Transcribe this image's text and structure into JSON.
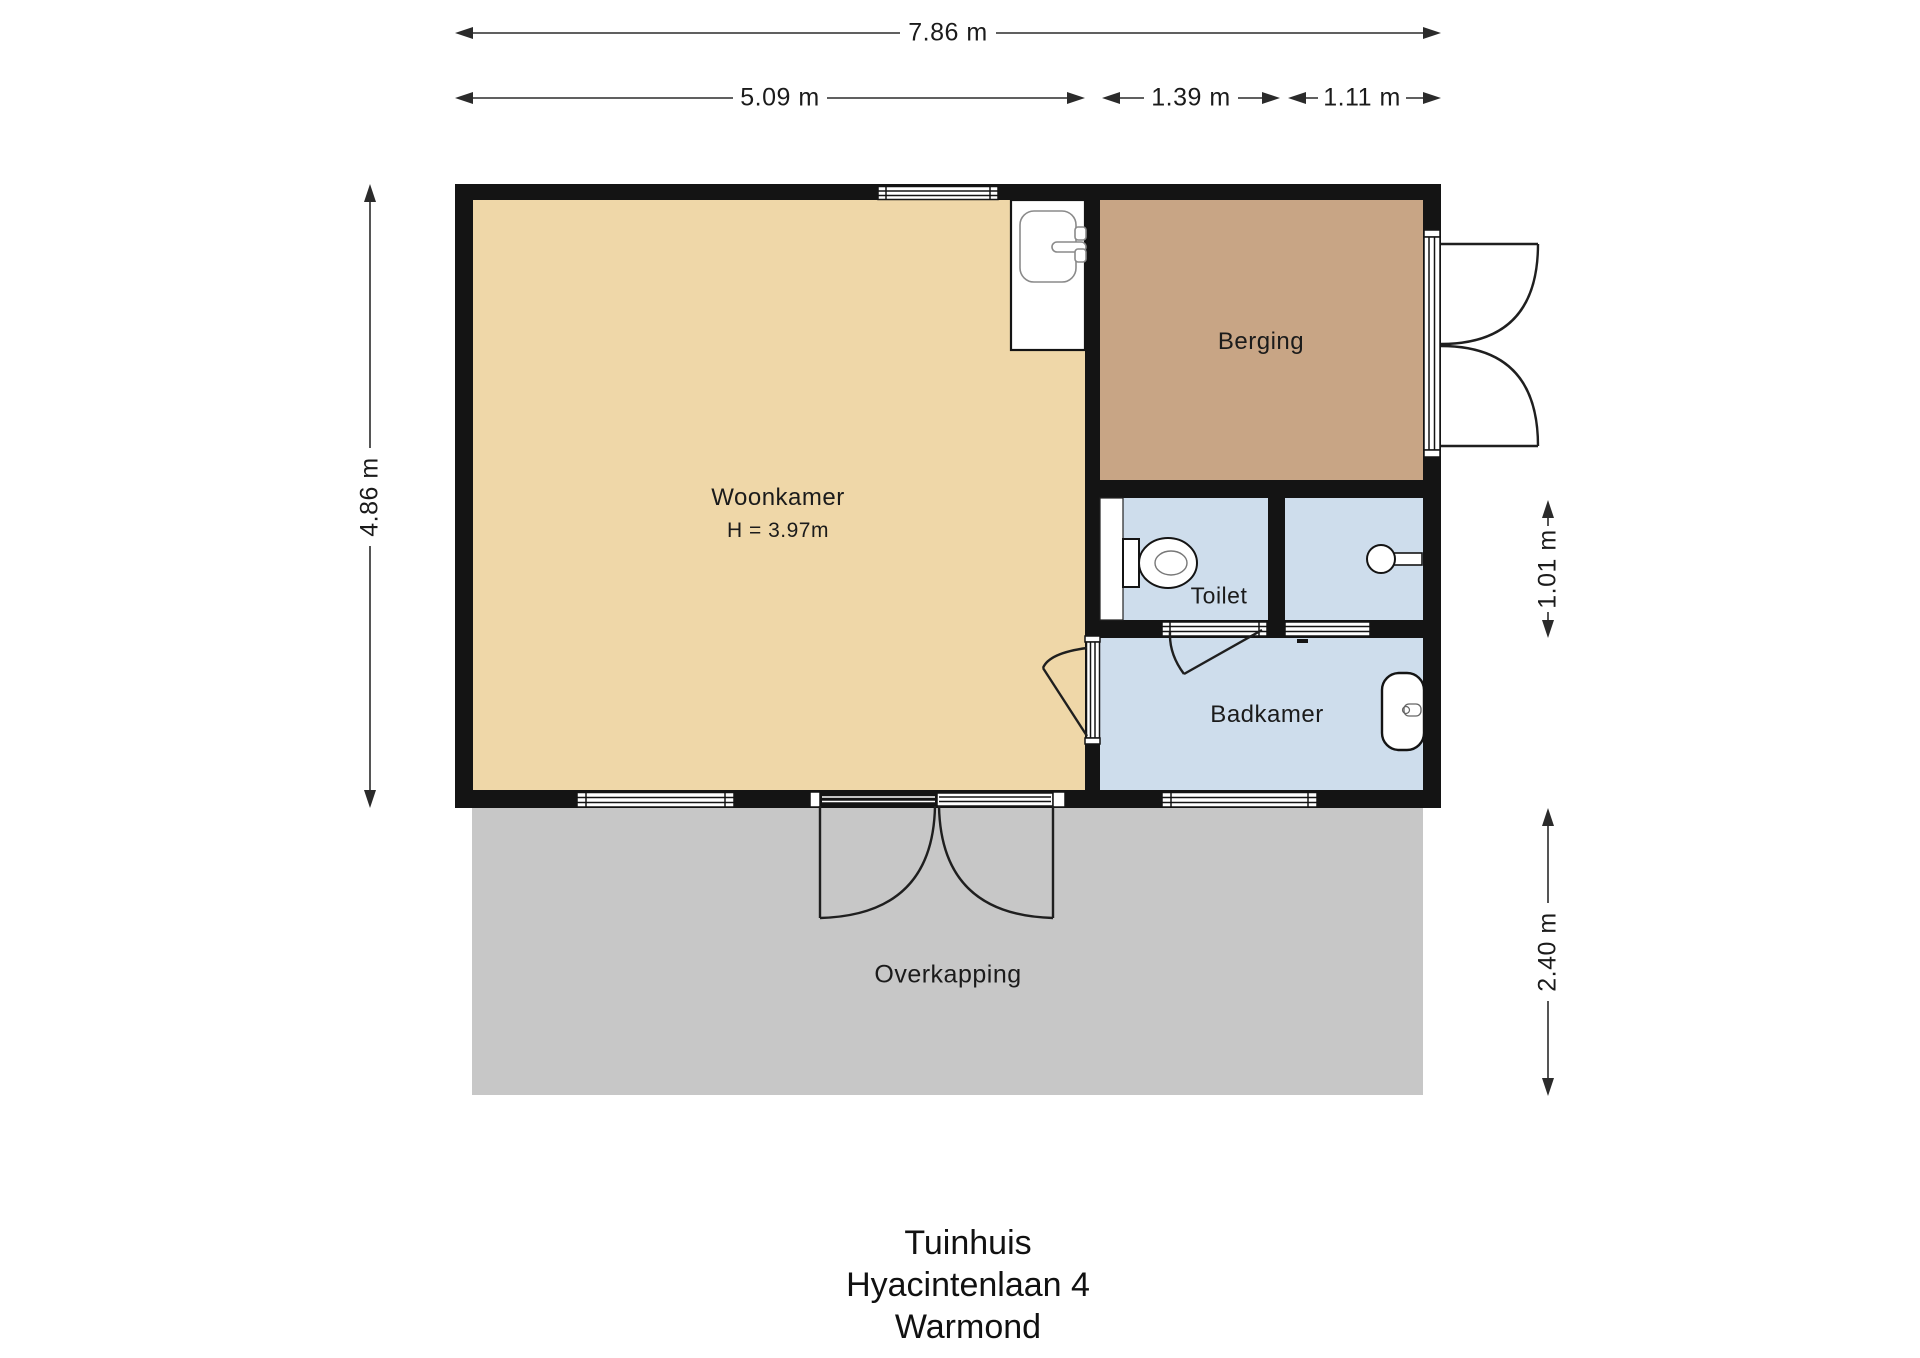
{
  "title": {
    "line1": "Tuinhuis",
    "line2": "Hyacintenlaan 4",
    "line3": "Warmond"
  },
  "plan": {
    "rooms": [
      {
        "key": "woonkamer",
        "label": "Woonkamer",
        "height_note": "H = 3.97m",
        "floor_color": "#EFD7A8"
      },
      {
        "key": "berging",
        "label": "Berging",
        "floor_color": "#C8A585"
      },
      {
        "key": "toilet",
        "label": "Toilet",
        "floor_color": "#CEDDEC"
      },
      {
        "key": "badkamer",
        "label": "Badkamer",
        "floor_color": "#CEDDEC"
      },
      {
        "key": "overkapping",
        "label": "Overkapping",
        "floor_color": "#C7C7C7"
      }
    ],
    "dimensions": {
      "total_width": "7.86 m",
      "living_width": "5.09 m",
      "toilet_col_width": "1.39 m",
      "shower_col_width": "1.11 m",
      "building_height": "4.86 m",
      "toilet_row_height": "1.01 m",
      "canopy_depth": "2.40 m"
    },
    "fixtures": [
      "kitchen-sink",
      "toilet",
      "wash-basin",
      "bathroom-sink"
    ],
    "colors": {
      "wall": "#141414",
      "dimension_line": "#2b2b2b",
      "woonkamer_floor": "#EFD7A8",
      "berging_floor": "#C8A585",
      "bath_floor": "#CEDDEC",
      "canopy_floor": "#C7C7C7"
    }
  }
}
